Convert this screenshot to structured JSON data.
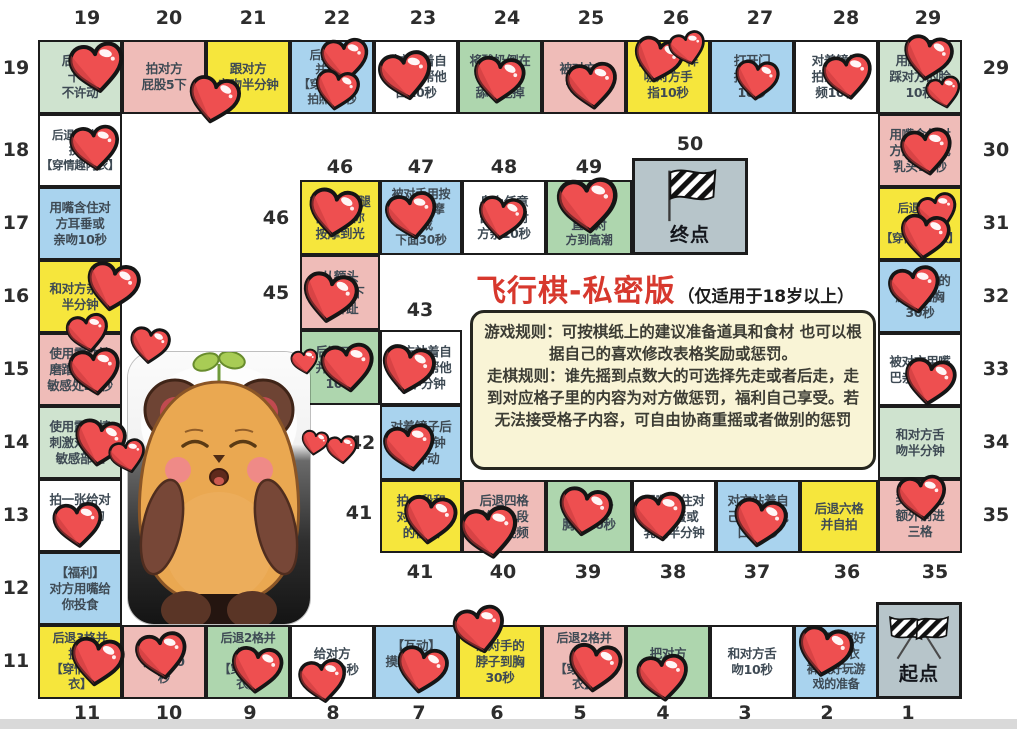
{
  "title": {
    "main": "飞行棋-私密版",
    "sub": "（仅适用于18岁以上）",
    "main_color": "#d7382d"
  },
  "rules": {
    "game": "游戏规则：可按棋纸上的建议准备道具和食材 也可以根据自己的喜欢修改表格奖励或惩罚。",
    "move": "走棋规则：谁先摇到点数大的可选择先走或者后走，走到对应格子里的内容为对方做惩罚，福利自己享受。若无法接受格子内容，可自由协商重摇或者做别的惩罚"
  },
  "start_label": "起点",
  "end_label": "终点",
  "colors": {
    "green1": "#cfe3cf",
    "green2": "#aed6ae",
    "pink": "#efbcb8",
    "yellow": "#f6e63c",
    "blue": "#a9d3ee",
    "white": "#ffffff",
    "gray": "#b7c5ca",
    "rules_bg": "#f9f4d6",
    "heart": "#ee4f50"
  },
  "cells": [
    {
      "n": 1,
      "x": 876,
      "y": 602,
      "w": 86,
      "h": 97,
      "c": "gray",
      "type": "start"
    },
    {
      "n": 2,
      "x": 794,
      "y": 625,
      "w": 84,
      "h": 74,
      "c": "blue",
      "lines": [
        "洗好澡穿好",
        "情趣内衣",
        "裤做好玩游",
        "戏的准备"
      ],
      "fs": 12
    },
    {
      "n": 3,
      "x": 710,
      "y": 625,
      "w": 84,
      "h": 74,
      "c": "white",
      "lines": [
        "和对方舌",
        "吻10秒"
      ]
    },
    {
      "n": 4,
      "x": 626,
      "y": 625,
      "w": 84,
      "h": 74,
      "c": "green2",
      "lines": [
        "把对方",
        "弄到湿"
      ]
    },
    {
      "n": 5,
      "x": 542,
      "y": 625,
      "w": 84,
      "h": 74,
      "c": "pink",
      "lines": [
        "后退2格并",
        "换上",
        "【穿情趣内",
        "衣】"
      ],
      "fs": 12
    },
    {
      "n": 6,
      "x": 458,
      "y": 625,
      "w": 84,
      "h": 74,
      "c": "yellow",
      "lines": [
        "亲对手的",
        "脖子到胸",
        "30秒"
      ]
    },
    {
      "n": 7,
      "x": 374,
      "y": 625,
      "w": 84,
      "h": 74,
      "c": "blue",
      "lines": [
        "【互动】",
        "摸对方摸自",
        "己"
      ]
    },
    {
      "n": 8,
      "x": 290,
      "y": 625,
      "w": 84,
      "h": 74,
      "c": "white",
      "lines": [
        "给对方",
        "按摩30秒"
      ]
    },
    {
      "n": 9,
      "x": 206,
      "y": 625,
      "w": 84,
      "h": 74,
      "c": "green2",
      "lines": [
        "后退2格并",
        "换上",
        "【穿情趣内",
        "衣】"
      ],
      "fs": 12
    },
    {
      "n": 10,
      "x": 122,
      "y": 625,
      "w": 84,
      "h": 74,
      "c": "pink",
      "lines": [
        "亲对方",
        "大腿20",
        "秒"
      ]
    },
    {
      "n": 11,
      "x": 38,
      "y": 625,
      "w": 84,
      "h": 74,
      "c": "yellow",
      "lines": [
        "后退3格并",
        "换上",
        "【穿情趣内",
        "衣】"
      ],
      "fs": 12
    },
    {
      "n": 12,
      "x": 38,
      "y": 552,
      "w": 84,
      "h": 73,
      "c": "blue",
      "lines": [
        "【福利】",
        "对方用嘴给",
        "你投食"
      ]
    },
    {
      "n": 13,
      "x": 38,
      "y": 479,
      "w": 84,
      "h": 73,
      "c": "white",
      "lines": [
        "拍一张给对",
        "方看你的",
        "照片"
      ]
    },
    {
      "n": 14,
      "x": 38,
      "y": 406,
      "w": 84,
      "h": 73,
      "c": "green1",
      "lines": [
        "使用震动棒",
        "刺激对方的",
        "敏感部位"
      ]
    },
    {
      "n": 15,
      "x": 38,
      "y": 333,
      "w": 84,
      "h": 73,
      "c": "pink",
      "lines": [
        "使用震动棒",
        "磨蹭自己的",
        "敏感处20秒"
      ]
    },
    {
      "n": 16,
      "x": 38,
      "y": 260,
      "w": 84,
      "h": 73,
      "c": "yellow",
      "lines": [
        "和对方亲亲",
        "半分钟"
      ]
    },
    {
      "n": 17,
      "x": 38,
      "y": 187,
      "w": 84,
      "h": 73,
      "c": "blue",
      "lines": [
        "用嘴含住对",
        "方耳垂或",
        "亲吻10秒"
      ]
    },
    {
      "n": 18,
      "x": 38,
      "y": 114,
      "w": 84,
      "h": 73,
      "c": "white",
      "lines": [
        "后退一格并",
        "换上",
        "【穿情趣内衣】"
      ],
      "fs": 11.5
    },
    {
      "n": 19,
      "x": 38,
      "y": 40,
      "w": 84,
      "h": 74,
      "c": "green1",
      "lines": [
        "后入式",
        "十下",
        "不许动"
      ]
    },
    {
      "n": 20,
      "x": 122,
      "y": 40,
      "w": 84,
      "h": 74,
      "c": "pink",
      "lines": [
        "拍对方",
        "屁股5下"
      ]
    },
    {
      "n": 21,
      "x": 206,
      "y": 40,
      "w": 84,
      "h": 74,
      "c": "yellow",
      "lines": [
        "跟对方",
        "亲吻半分钟"
      ]
    },
    {
      "n": 22,
      "x": 290,
      "y": 40,
      "w": 84,
      "h": 74,
      "c": "blue",
      "lines": [
        "后退六格",
        "并换上",
        "【穿情趣衣】",
        "拍照10秒"
      ],
      "fs": 11.5
    },
    {
      "n": 23,
      "x": 374,
      "y": 40,
      "w": 84,
      "h": 74,
      "c": "white",
      "lines": [
        "对方站着自",
        "己跪着帮他",
        "口10秒"
      ]
    },
    {
      "n": 24,
      "x": 458,
      "y": 40,
      "w": 84,
      "h": 74,
      "c": "green2",
      "lines": [
        "将酸奶倒在",
        "乳头上",
        "舔着吃掉"
      ]
    },
    {
      "n": 25,
      "x": 542,
      "y": 40,
      "w": 84,
      "h": 74,
      "c": "pink",
      "lines": [
        "被对方堵",
        "一分钟"
      ]
    },
    {
      "n": 26,
      "x": 626,
      "y": 40,
      "w": 84,
      "h": 74,
      "c": "yellow",
      "lines": [
        "像宝宝一样",
        "吸对方手",
        "指10秒"
      ]
    },
    {
      "n": 27,
      "x": 710,
      "y": 40,
      "w": 84,
      "h": 74,
      "c": "blue",
      "lines": [
        "打开门",
        "抱对方",
        "10秒"
      ]
    },
    {
      "n": 28,
      "x": 794,
      "y": 40,
      "w": 84,
      "h": 74,
      "c": "white",
      "lines": [
        "对着镜子",
        "拍亲吻视",
        "频10秒"
      ]
    },
    {
      "n": 29,
      "x": 878,
      "y": 40,
      "w": 84,
      "h": 74,
      "c": "green1",
      "lines": [
        "用脚轻轻",
        "踩对方的脸",
        "10秒"
      ]
    },
    {
      "n": 30,
      "x": 878,
      "y": 114,
      "w": 84,
      "h": 73,
      "c": "pink",
      "lines": [
        "用嘴含住对",
        "方的蛋蛋或",
        "乳头10秒"
      ]
    },
    {
      "n": 31,
      "x": 878,
      "y": 187,
      "w": 84,
      "h": 73,
      "c": "yellow",
      "lines": [
        "后退四格",
        "并换上",
        "【穿情趣内衣】"
      ],
      "fs": 11.5
    },
    {
      "n": 32,
      "x": 878,
      "y": 260,
      "w": 84,
      "h": 73,
      "c": "blue",
      "lines": [
        "亲吻对方的",
        "脖子到胸",
        "30秒"
      ]
    },
    {
      "n": 33,
      "x": 878,
      "y": 333,
      "w": 84,
      "h": 73,
      "c": "white",
      "lines": [
        "被对方用嘴",
        "巴亲遍全身"
      ]
    },
    {
      "n": 34,
      "x": 878,
      "y": 406,
      "w": 84,
      "h": 73,
      "c": "green1",
      "lines": [
        "和对方舌",
        "吻半分钟"
      ]
    },
    {
      "n": 35,
      "x": 878,
      "y": 479,
      "w": 84,
      "h": 74,
      "c": "pink",
      "lines": [
        "奖励自己",
        "额外前进",
        "三格"
      ]
    },
    {
      "n": 36,
      "x": 800,
      "y": 480,
      "w": 78,
      "h": 73,
      "c": "yellow",
      "lines": [
        "后退六格",
        "并自拍"
      ]
    },
    {
      "n": 37,
      "x": 716,
      "y": 480,
      "w": 84,
      "h": 73,
      "c": "blue",
      "lines": [
        "对方站着自",
        "己跪着帮他",
        "口10秒"
      ]
    },
    {
      "n": 38,
      "x": 632,
      "y": 480,
      "w": 84,
      "h": 73,
      "c": "white",
      "lines": [
        "用嘴含住对",
        "方蛋蛋或",
        "乳头半分钟"
      ]
    },
    {
      "n": 39,
      "x": 546,
      "y": 480,
      "w": 86,
      "h": 73,
      "c": "green2",
      "lines": [
        "揉捏对方",
        "胸部10秒"
      ]
    },
    {
      "n": 40,
      "x": 462,
      "y": 480,
      "w": 84,
      "h": 73,
      "c": "pink",
      "lines": [
        "后退四格",
        "并拍一段",
        "亲吻视频"
      ]
    },
    {
      "n": 41,
      "x": 380,
      "y": 480,
      "w": 82,
      "h": 73,
      "c": "yellow",
      "lines": [
        "拍一段和",
        "对方亲吻",
        "的视频"
      ]
    },
    {
      "n": 42,
      "x": 380,
      "y": 405,
      "w": 82,
      "h": 75,
      "c": "blue",
      "lines": [
        "对着镜子后",
        "入一分钟",
        "不许动"
      ]
    },
    {
      "n": 43,
      "x": 380,
      "y": 330,
      "w": 82,
      "h": 75,
      "c": "white",
      "lines": [
        "对方站着自",
        "己跪着帮他",
        "口半分钟"
      ]
    },
    {
      "n": 44,
      "x": 300,
      "y": 330,
      "w": 80,
      "h": 75,
      "c": "green2",
      "lines": [
        "后退二格",
        "并亲对方",
        "10下"
      ]
    },
    {
      "n": 45,
      "x": 300,
      "y": 255,
      "w": 80,
      "h": 75,
      "c": "pink",
      "lines": [
        "从额头",
        "一路亲下",
        "到脚趾"
      ]
    },
    {
      "n": 46,
      "x": 300,
      "y": 180,
      "w": 80,
      "h": 75,
      "c": "yellow",
      "lines": [
        "对手的大腿",
        "内侧给你",
        "按摩到光"
      ]
    },
    {
      "n": 47,
      "x": 380,
      "y": 180,
      "w": 82,
      "h": 75,
      "c": "blue",
      "lines": [
        "被对手用按",
        "摩器按摩",
        "胸或",
        "下面30秒"
      ],
      "fs": 12
    },
    {
      "n": 48,
      "x": 462,
      "y": 180,
      "w": 84,
      "h": 75,
      "c": "white",
      "lines": [
        "身上任意",
        "部位给对",
        "方亲10秒"
      ]
    },
    {
      "n": 49,
      "x": 546,
      "y": 180,
      "w": 86,
      "h": 75,
      "c": "green2",
      "lines": [
        "使用玩具",
        "刺激",
        "直到对",
        "方到高潮"
      ],
      "fs": 12
    },
    {
      "n": 50,
      "x": 632,
      "y": 158,
      "w": 116,
      "h": 97,
      "c": "gray",
      "type": "end"
    }
  ],
  "numbers": [
    {
      "t": "19",
      "x": 87,
      "y": 18
    },
    {
      "t": "20",
      "x": 169,
      "y": 18
    },
    {
      "t": "21",
      "x": 253,
      "y": 18
    },
    {
      "t": "22",
      "x": 337,
      "y": 18
    },
    {
      "t": "23",
      "x": 423,
      "y": 18
    },
    {
      "t": "24",
      "x": 507,
      "y": 18
    },
    {
      "t": "25",
      "x": 591,
      "y": 18
    },
    {
      "t": "26",
      "x": 676,
      "y": 18
    },
    {
      "t": "27",
      "x": 760,
      "y": 18
    },
    {
      "t": "28",
      "x": 846,
      "y": 18
    },
    {
      "t": "29",
      "x": 928,
      "y": 18
    },
    {
      "t": "19",
      "x": 16,
      "y": 68
    },
    {
      "t": "18",
      "x": 16,
      "y": 150
    },
    {
      "t": "17",
      "x": 16,
      "y": 223
    },
    {
      "t": "16",
      "x": 16,
      "y": 296
    },
    {
      "t": "15",
      "x": 16,
      "y": 369
    },
    {
      "t": "14",
      "x": 16,
      "y": 442
    },
    {
      "t": "13",
      "x": 16,
      "y": 515
    },
    {
      "t": "12",
      "x": 16,
      "y": 588
    },
    {
      "t": "11",
      "x": 16,
      "y": 661
    },
    {
      "t": "29",
      "x": 996,
      "y": 68
    },
    {
      "t": "30",
      "x": 996,
      "y": 150
    },
    {
      "t": "31",
      "x": 996,
      "y": 223
    },
    {
      "t": "32",
      "x": 996,
      "y": 296
    },
    {
      "t": "33",
      "x": 996,
      "y": 369
    },
    {
      "t": "34",
      "x": 996,
      "y": 442
    },
    {
      "t": "35",
      "x": 996,
      "y": 515
    },
    {
      "t": "11",
      "x": 87,
      "y": 713
    },
    {
      "t": "10",
      "x": 169,
      "y": 713
    },
    {
      "t": "9",
      "x": 250,
      "y": 713
    },
    {
      "t": "8",
      "x": 333,
      "y": 713
    },
    {
      "t": "7",
      "x": 419,
      "y": 713
    },
    {
      "t": "6",
      "x": 497,
      "y": 713
    },
    {
      "t": "5",
      "x": 580,
      "y": 713
    },
    {
      "t": "4",
      "x": 663,
      "y": 713
    },
    {
      "t": "3",
      "x": 745,
      "y": 713
    },
    {
      "t": "2",
      "x": 827,
      "y": 713
    },
    {
      "t": "1",
      "x": 908,
      "y": 713
    },
    {
      "t": "46",
      "x": 340,
      "y": 167
    },
    {
      "t": "47",
      "x": 421,
      "y": 167
    },
    {
      "t": "48",
      "x": 504,
      "y": 167
    },
    {
      "t": "49",
      "x": 589,
      "y": 167
    },
    {
      "t": "50",
      "x": 690,
      "y": 144
    },
    {
      "t": "46",
      "x": 276,
      "y": 218
    },
    {
      "t": "45",
      "x": 276,
      "y": 293
    },
    {
      "t": "44",
      "x": 272,
      "y": 367
    },
    {
      "t": "43",
      "x": 420,
      "y": 310
    },
    {
      "t": "42",
      "x": 362,
      "y": 443
    },
    {
      "t": "41",
      "x": 359,
      "y": 513
    },
    {
      "t": "41",
      "x": 420,
      "y": 572
    },
    {
      "t": "40",
      "x": 503,
      "y": 572
    },
    {
      "t": "39",
      "x": 588,
      "y": 572
    },
    {
      "t": "38",
      "x": 673,
      "y": 572
    },
    {
      "t": "37",
      "x": 757,
      "y": 572
    },
    {
      "t": "36",
      "x": 847,
      "y": 572
    },
    {
      "t": "35",
      "x": 935,
      "y": 572
    }
  ],
  "hearts": [
    {
      "x": 97,
      "y": 68,
      "s": 60,
      "r": -8
    },
    {
      "x": 214,
      "y": 100,
      "s": 56,
      "r": 10
    },
    {
      "x": 345,
      "y": 60,
      "s": 52,
      "r": -5
    },
    {
      "x": 337,
      "y": 90,
      "s": 48,
      "r": 8
    },
    {
      "x": 406,
      "y": 76,
      "s": 58,
      "r": -10
    },
    {
      "x": 499,
      "y": 80,
      "s": 56,
      "r": 6
    },
    {
      "x": 592,
      "y": 86,
      "s": 56,
      "r": -6
    },
    {
      "x": 658,
      "y": 60,
      "s": 54,
      "r": 12
    },
    {
      "x": 688,
      "y": 48,
      "s": 40,
      "r": -15
    },
    {
      "x": 757,
      "y": 80,
      "s": 48,
      "r": 5
    },
    {
      "x": 848,
      "y": 77,
      "s": 54,
      "r": -8
    },
    {
      "x": 928,
      "y": 58,
      "s": 54,
      "r": 8
    },
    {
      "x": 944,
      "y": 92,
      "s": 38,
      "r": -12
    },
    {
      "x": 95,
      "y": 148,
      "s": 54,
      "r": -6
    },
    {
      "x": 113,
      "y": 287,
      "s": 58,
      "r": 9
    },
    {
      "x": 88,
      "y": 333,
      "s": 46,
      "r": -10
    },
    {
      "x": 150,
      "y": 345,
      "s": 44,
      "r": 6
    },
    {
      "x": 95,
      "y": 372,
      "s": 56,
      "r": -7
    },
    {
      "x": 100,
      "y": 443,
      "s": 56,
      "r": 8
    },
    {
      "x": 128,
      "y": 456,
      "s": 40,
      "r": -14
    },
    {
      "x": 78,
      "y": 525,
      "s": 54,
      "r": -5
    },
    {
      "x": 97,
      "y": 662,
      "s": 58,
      "r": 7
    },
    {
      "x": 162,
      "y": 656,
      "s": 56,
      "r": -9
    },
    {
      "x": 257,
      "y": 670,
      "s": 56,
      "r": 5
    },
    {
      "x": 323,
      "y": 681,
      "s": 52,
      "r": -7
    },
    {
      "x": 422,
      "y": 670,
      "s": 56,
      "r": 9
    },
    {
      "x": 480,
      "y": 630,
      "s": 56,
      "r": -12
    },
    {
      "x": 595,
      "y": 668,
      "s": 58,
      "r": 6
    },
    {
      "x": 663,
      "y": 678,
      "s": 56,
      "r": -6
    },
    {
      "x": 825,
      "y": 652,
      "s": 60,
      "r": 10
    },
    {
      "x": 927,
      "y": 152,
      "s": 56,
      "r": -8
    },
    {
      "x": 938,
      "y": 212,
      "s": 44,
      "r": -16
    },
    {
      "x": 925,
      "y": 237,
      "s": 54,
      "r": 6
    },
    {
      "x": 915,
      "y": 290,
      "s": 56,
      "r": -9
    },
    {
      "x": 930,
      "y": 382,
      "s": 56,
      "r": 7
    },
    {
      "x": 922,
      "y": 498,
      "s": 54,
      "r": -6
    },
    {
      "x": 335,
      "y": 213,
      "s": 58,
      "r": 8
    },
    {
      "x": 412,
      "y": 216,
      "s": 56,
      "r": -10
    },
    {
      "x": 502,
      "y": 218,
      "s": 52,
      "r": 7
    },
    {
      "x": 588,
      "y": 205,
      "s": 66,
      "r": -5
    },
    {
      "x": 330,
      "y": 298,
      "s": 60,
      "r": 9
    },
    {
      "x": 305,
      "y": 362,
      "s": 30,
      "r": -10
    },
    {
      "x": 348,
      "y": 368,
      "s": 58,
      "r": -7
    },
    {
      "x": 408,
      "y": 370,
      "s": 58,
      "r": 10
    },
    {
      "x": 315,
      "y": 443,
      "s": 30,
      "r": 8
    },
    {
      "x": 410,
      "y": 448,
      "s": 56,
      "r": -9
    },
    {
      "x": 430,
      "y": 520,
      "s": 58,
      "r": 6
    },
    {
      "x": 490,
      "y": 533,
      "s": 62,
      "r": -8
    },
    {
      "x": 585,
      "y": 512,
      "s": 58,
      "r": 9
    },
    {
      "x": 660,
      "y": 517,
      "s": 58,
      "r": -7
    },
    {
      "x": 760,
      "y": 523,
      "s": 58,
      "r": 8
    },
    {
      "x": 342,
      "y": 450,
      "s": 34,
      "r": -5
    }
  ]
}
